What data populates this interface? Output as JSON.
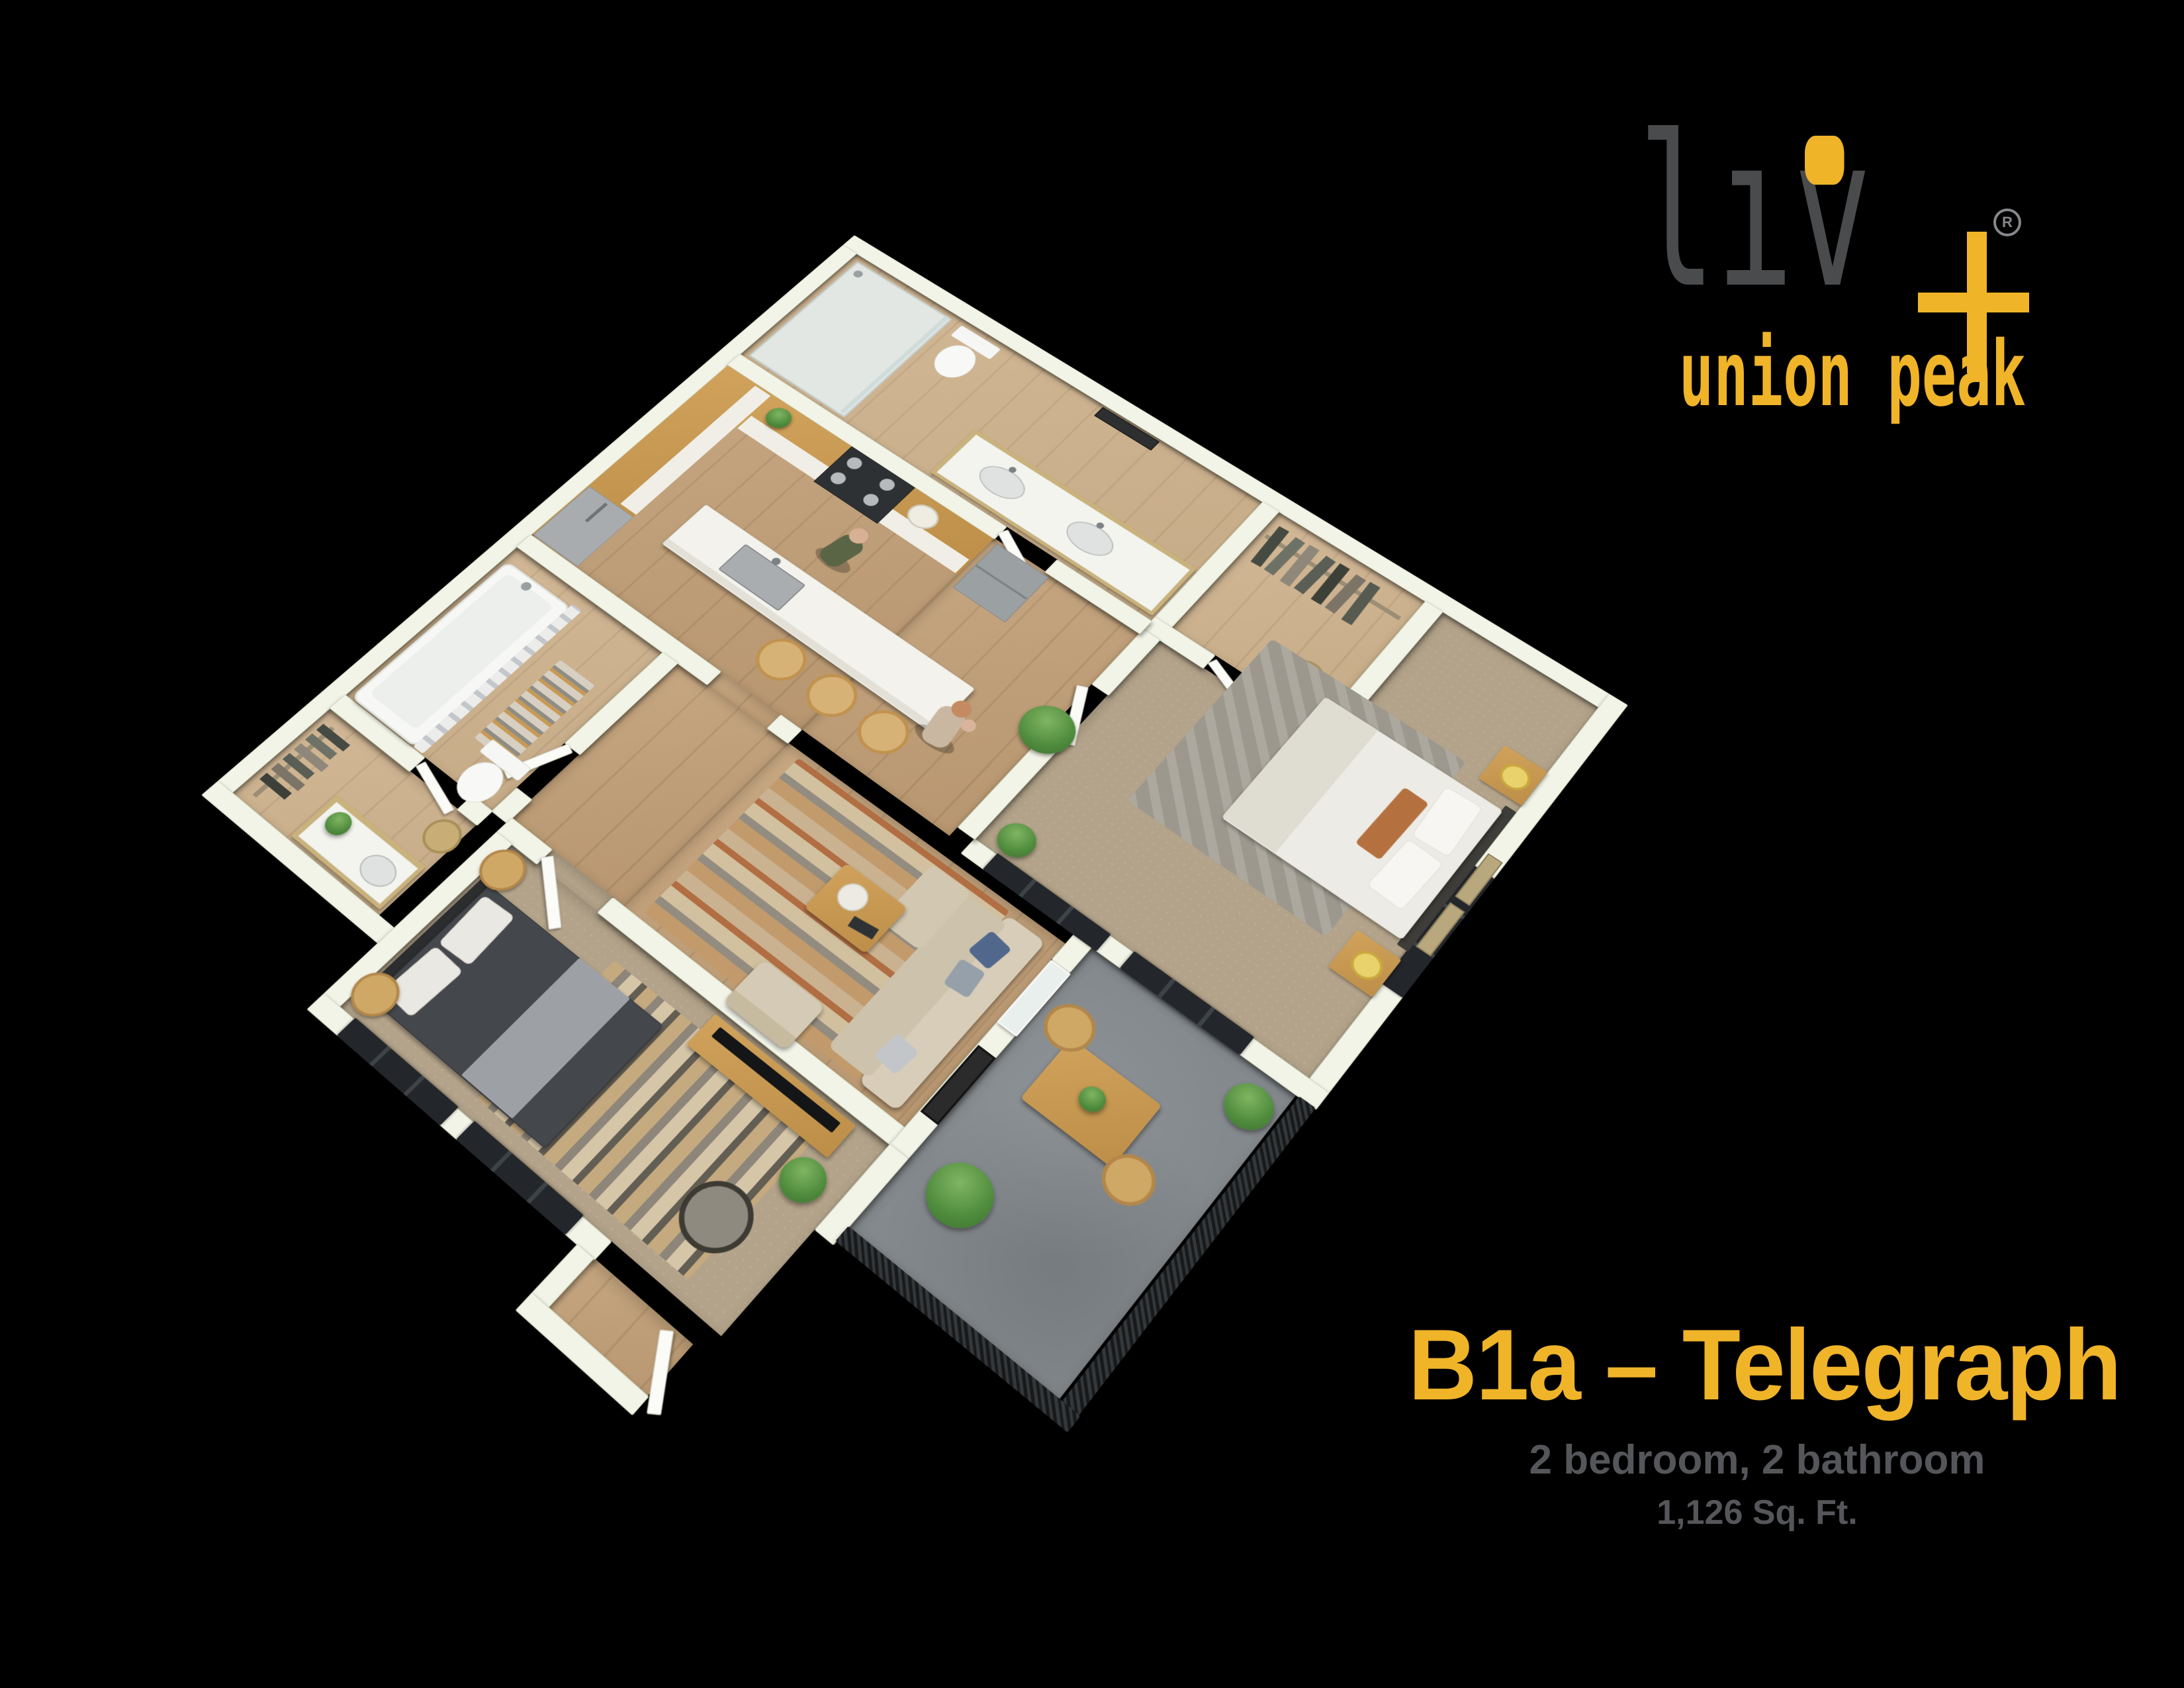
{
  "brand": {
    "logo_word": "liv",
    "logo_l1": "l",
    "logo_l2": "ı",
    "logo_l3": "v",
    "plus_sign": "+",
    "registered_mark": "R",
    "tagline": "union peak",
    "accent_color": "#F0B429",
    "logo_gray": "#4A4B4D"
  },
  "caption": {
    "title": "B1a – Telegraph",
    "subtitle": "2 bedroom, 2 bathroom",
    "area": "1,126 Sq. Ft.",
    "title_color": "#F0B429",
    "text_color": "#55565A"
  },
  "palette": {
    "background": "#000000",
    "wall": "#F2F4E8",
    "wood_floor": "#BD9C76",
    "carpet": "#B3A38A",
    "balcony_concrete": "#84898D",
    "cabinet_wood": "#C89A52",
    "window_frame": "#23262A"
  }
}
